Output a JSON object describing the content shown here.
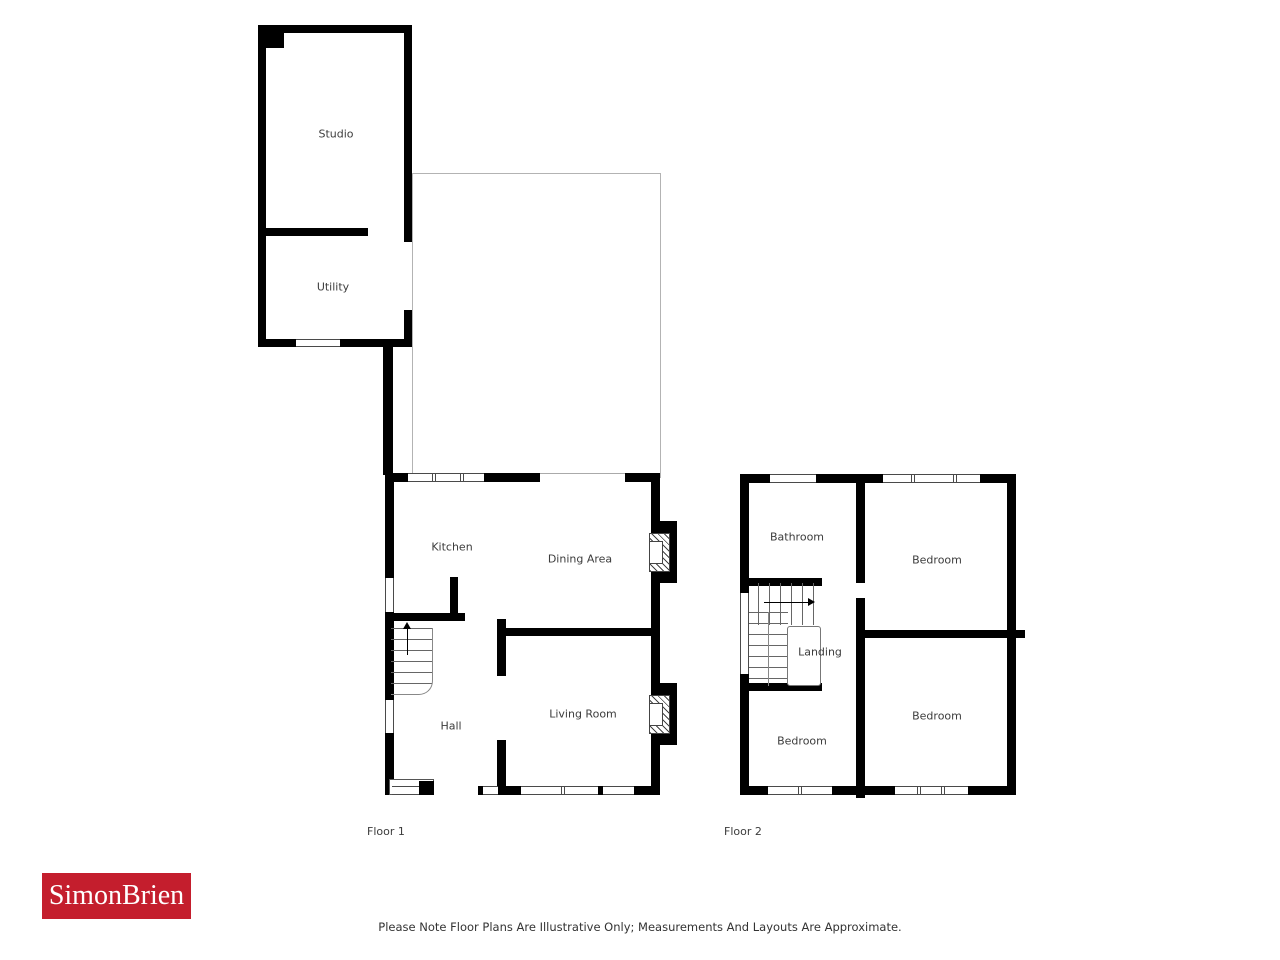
{
  "page": {
    "disclaimer": "Please Note Floor Plans Are Illustrative Only; Measurements And Layouts Are Approximate."
  },
  "logo": {
    "text": "SimonBrien"
  },
  "floor1": {
    "label": "Floor 1",
    "rooms": {
      "studio": "Studio",
      "utility": "Utility",
      "kitchen": "Kitchen",
      "dining_area": "Dining Area",
      "hall": "Hall",
      "living_room": "Living Room"
    }
  },
  "floor2": {
    "label": "Floor 2",
    "rooms": {
      "bathroom": "Bathroom",
      "bedroom_front": "Bedroom",
      "landing": "Landing",
      "bedroom_back_left": "Bedroom",
      "bedroom_back_right": "Bedroom"
    }
  },
  "colors": {
    "wall": "#000000",
    "boundary_outline": "#b3b3b3",
    "logo_red": "#c41e2d",
    "label_text": "#3c3c3c",
    "window_line": "#4a4a4a",
    "stair_line": "#666666"
  }
}
